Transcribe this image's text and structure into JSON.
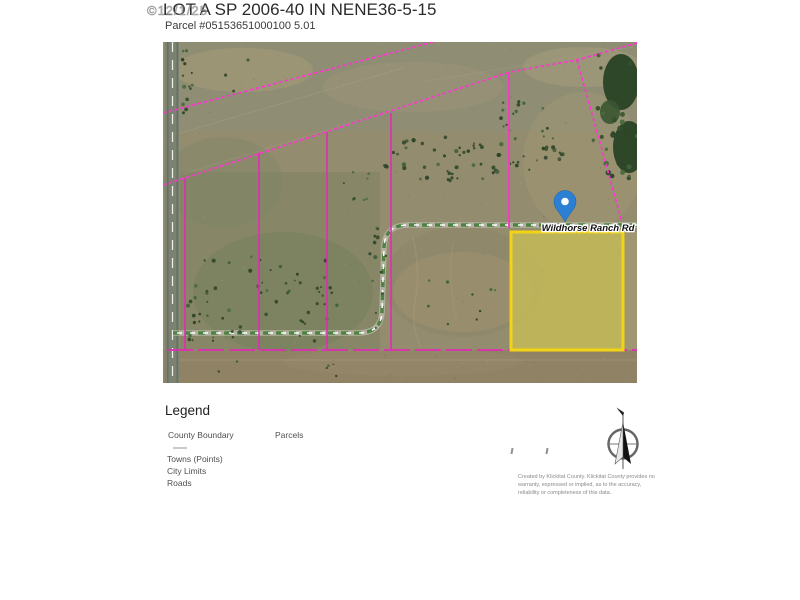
{
  "header": {
    "watermark": "©12/1/25",
    "title": "LOT A SP 2006-40 IN NENE36-5-15",
    "subtitle": "Parcel #05153651000100 5.01"
  },
  "map": {
    "road_label": "Wildhorse Ranch Rd",
    "marker_icon": "location-pin",
    "colors": {
      "boundary_dashed": "#ff35cf",
      "parcel_solid": "#e02cb4",
      "selected_parcel_outline": "#f2d414",
      "selected_parcel_fill": "rgba(244,224,94,0.32)",
      "marker_blue": "#2b80d4",
      "road_dash_green": "#3c7a33"
    }
  },
  "legend": {
    "heading": "Legend",
    "items": [
      {
        "label": "County Boundary"
      },
      {
        "label": "Parcels"
      },
      {
        "label": "Towns (Points)"
      },
      {
        "label": "City Limits"
      },
      {
        "label": "Roads"
      }
    ]
  },
  "footer": {
    "compass_icon": "north-arrow",
    "disclaimer_lines": [
      "Created by Klickitat County. Klickitat County provides no",
      "warranty, expressed or implied, as to the accuracy,",
      "reliability or completeness of this data."
    ]
  }
}
